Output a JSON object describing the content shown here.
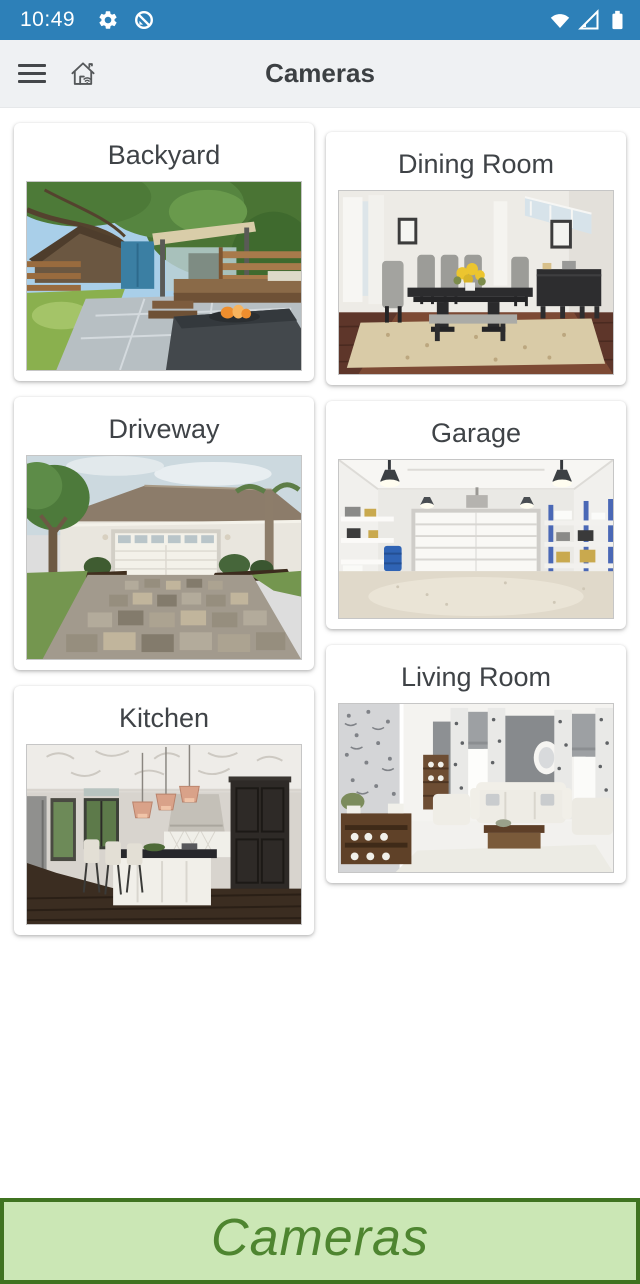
{
  "status_bar": {
    "time": "10:49",
    "bg_color": "#2d80b8",
    "left_icons": [
      "settings-gear-icon",
      "data-saver-icon"
    ],
    "right_icons": [
      "wifi-icon",
      "cell-signal-icon",
      "battery-icon"
    ]
  },
  "app_bar": {
    "title": "Cameras",
    "icons": [
      "menu-icon",
      "smart-home-icon"
    ]
  },
  "cameras": [
    {
      "name": "Backyard"
    },
    {
      "name": "Dining Room"
    },
    {
      "name": "Driveway"
    },
    {
      "name": "Garage"
    },
    {
      "name": "Kitchen"
    },
    {
      "name": "Living Room"
    }
  ],
  "footer": {
    "label": "Cameras",
    "bg_color": "#cbe7b5",
    "border_color": "#3f7320",
    "text_color": "#4e8530"
  }
}
